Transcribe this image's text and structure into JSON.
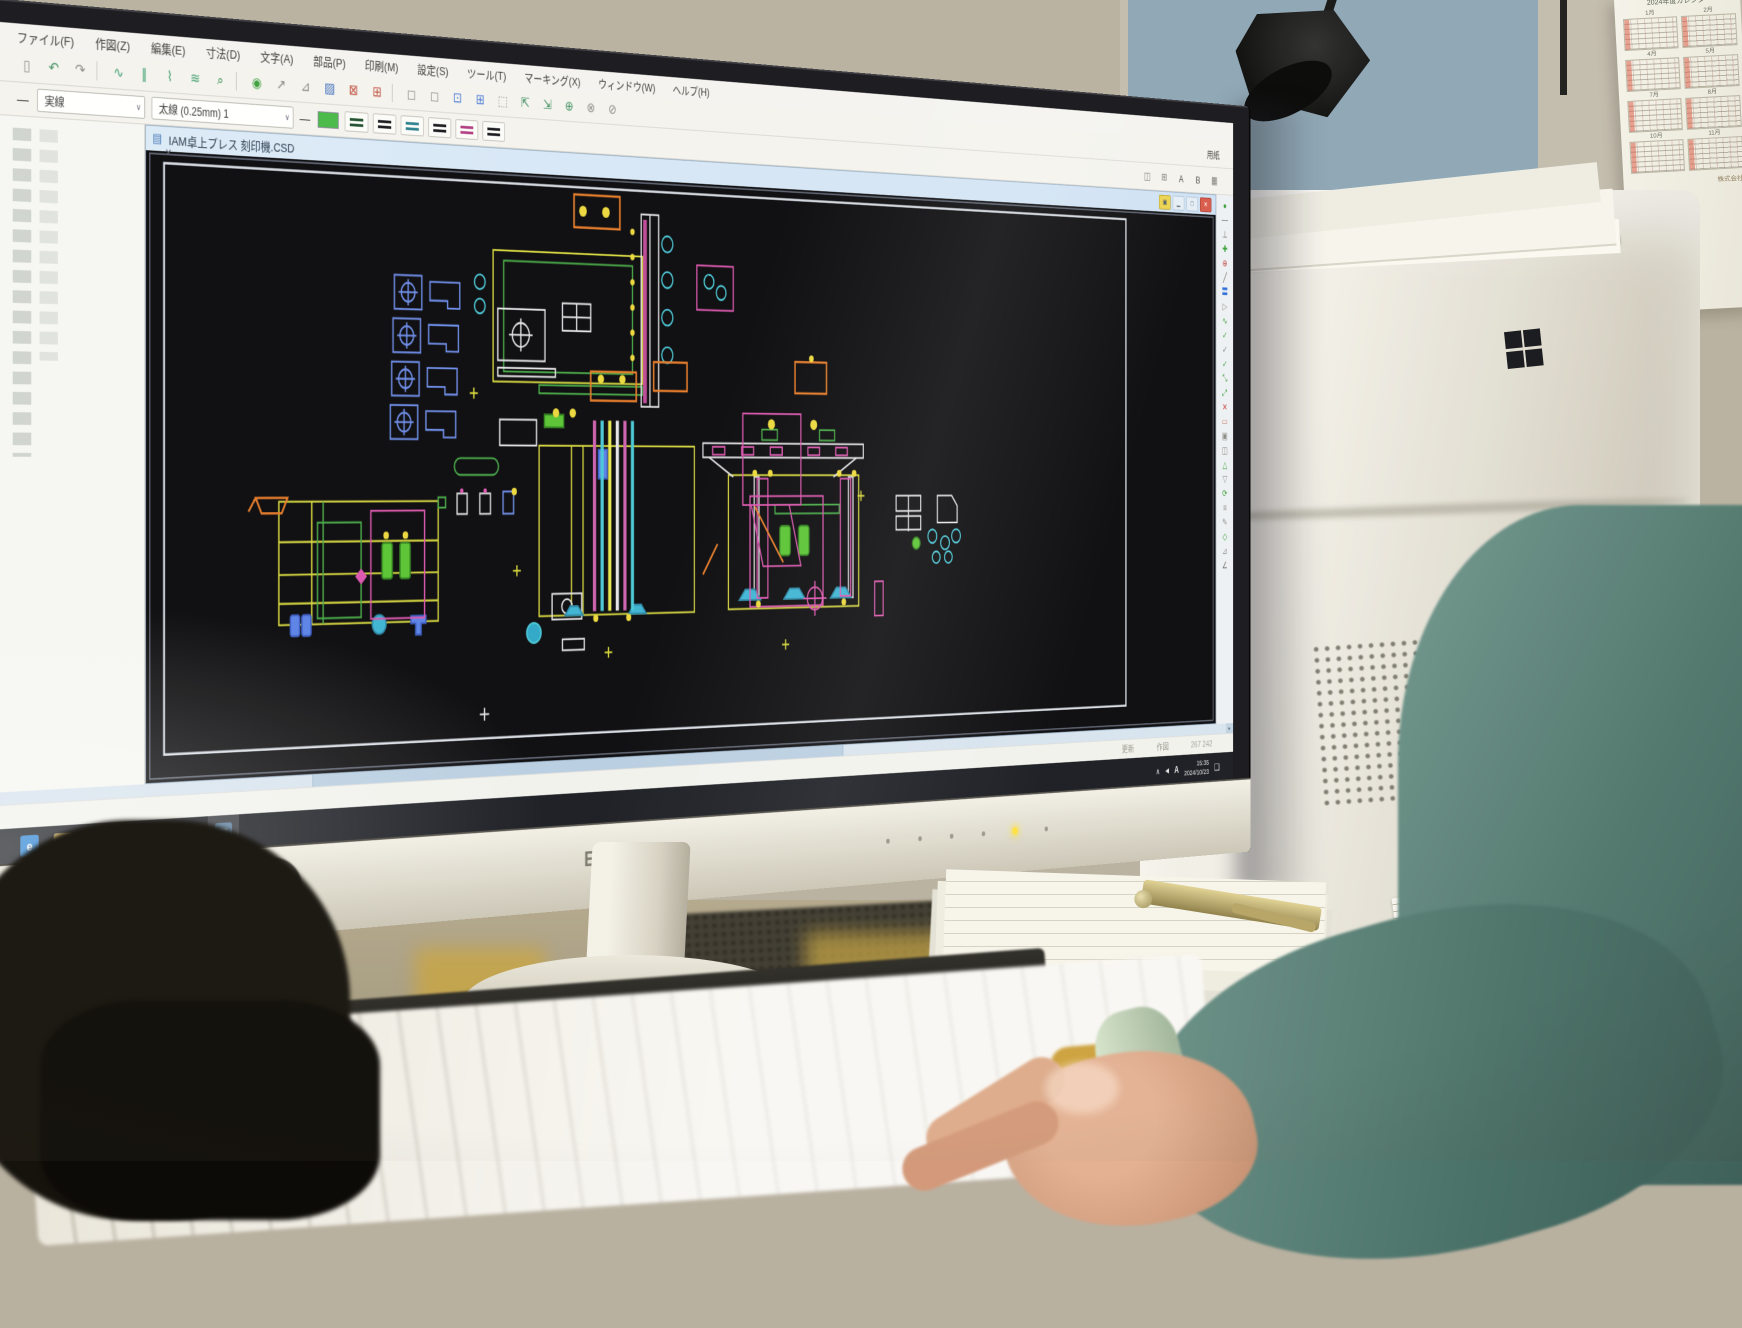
{
  "scene": {
    "monitor": {
      "brand": "EPSON"
    },
    "calendar": {
      "title": "2024年度カレンダー",
      "months": [
        "1月",
        "2月",
        "4月",
        "5月",
        "7月",
        "8月",
        "10月",
        "11月"
      ],
      "footer": "株式会社"
    }
  },
  "app": {
    "menus": [
      "ファイル(F)",
      "作図(Z)",
      "編集(E)",
      "寸法(D)",
      "文字(A)",
      "部品(P)",
      "印刷(M)",
      "設定(S)",
      "ツール(T)",
      "マーキング(X)",
      "ウィンドウ(W)",
      "ヘルプ(H)"
    ],
    "toolbar1": [
      {
        "g": "▯",
        "c": "#8a8a84"
      },
      {
        "g": "↶",
        "c": "#3f8f5f"
      },
      {
        "g": "↷",
        "c": "#8a8a84"
      },
      {
        "g": "",
        "cls": "sep"
      },
      {
        "g": "∿",
        "c": "#3f9f6f"
      },
      {
        "g": "∥",
        "c": "#3f9f6f"
      },
      {
        "g": "⌇",
        "c": "#3f9f6f"
      },
      {
        "g": "≋",
        "c": "#3f9f6f"
      },
      {
        "g": "⌕",
        "c": "#2f8f4f"
      },
      {
        "g": "",
        "cls": "sep"
      },
      {
        "g": "◉",
        "c": "#3a9e3a"
      },
      {
        "g": "↗",
        "c": "#8a8a84"
      },
      {
        "g": "⊿",
        "c": "#8a8a84"
      },
      {
        "g": "▨",
        "c": "#3f6fbf"
      },
      {
        "g": "⊠",
        "c": "#bf4f3f"
      },
      {
        "g": "⊞",
        "c": "#bf4f3f"
      },
      {
        "g": "",
        "cls": "sep"
      },
      {
        "g": "◻",
        "c": "#8a8a84"
      },
      {
        "g": "◻",
        "c": "#8a8a84"
      },
      {
        "g": "⊡",
        "c": "#4a7ad8"
      },
      {
        "g": "⊞",
        "c": "#4a7ad8"
      },
      {
        "g": "⬚",
        "c": "#8a8a84"
      },
      {
        "g": "⇱",
        "c": "#3f8f5f"
      },
      {
        "g": "⇲",
        "c": "#3f8f5f"
      },
      {
        "g": "⊕",
        "c": "#3f8f5f"
      },
      {
        "g": "⊗",
        "c": "#8a8a84"
      },
      {
        "g": "⊘",
        "c": "#8a8a84"
      },
      {
        "g": "",
        "cls": "flex"
      },
      {
        "g": "用紙",
        "cls": "lbl"
      }
    ],
    "toolbar2": {
      "sample": "—",
      "linetype": "実線",
      "linewidth": "太線 (0.25mm) 1",
      "caret": "∨",
      "swatch": "#48b848",
      "styles": [
        "#1d4f2d",
        "#17171c",
        "#2a7f8f",
        "#17171c",
        "#b03a7f",
        "#17171c"
      ],
      "right_icons": [
        {
          "g": "◫",
          "c": "#7a7a74"
        },
        {
          "g": "⊞",
          "c": "#7a7a74"
        },
        {
          "g": "A",
          "c": "#4a4a44"
        },
        {
          "g": "B",
          "c": "#4a4a44"
        },
        {
          "g": "▦",
          "c": "#7a7a74"
        }
      ],
      "panel_close": "×"
    },
    "doc": {
      "title": "IAM卓上プレス 刻印機.CSD",
      "tab_icon": "▤",
      "controls": {
        "layer": "▣",
        "min": "▁",
        "max": "□",
        "close": "✕"
      }
    },
    "right_toolbar": [
      {
        "g": "●",
        "c": "#3a9e3a"
      },
      {
        "g": "—",
        "c": "#66665f"
      },
      {
        "g": "⊥",
        "c": "#66665f"
      },
      {
        "g": "✚",
        "c": "#2f9f2f"
      },
      {
        "g": "⊕",
        "c": "#c04848"
      },
      {
        "g": "╱",
        "c": "#66665f"
      },
      {
        "g": "〓",
        "c": "#2a6ed8"
      },
      {
        "g": "▷",
        "c": "#8a8a84"
      },
      {
        "g": "∿",
        "c": "#3a9e3a"
      },
      {
        "g": "✓",
        "c": "#3a9e3a"
      },
      {
        "g": "✓",
        "c": "#7a7a74"
      },
      {
        "g": "✓",
        "c": "#3a9e3a"
      },
      {
        "g": "⤡",
        "c": "#3a9e3a"
      },
      {
        "g": "⤢",
        "c": "#3a9e3a"
      },
      {
        "g": "✕",
        "c": "#c84040"
      },
      {
        "g": "▭",
        "c": "#c87a6a"
      },
      {
        "g": "▣",
        "c": "#8a8a84"
      },
      {
        "g": "◫",
        "c": "#8a8a84"
      },
      {
        "g": "△",
        "c": "#3a9e3a"
      },
      {
        "g": "▽",
        "c": "#8a8a84"
      },
      {
        "g": "⟳",
        "c": "#3a9e3a"
      },
      {
        "g": "≡",
        "c": "#8a8a84"
      },
      {
        "g": "✎",
        "c": "#8a8a84"
      },
      {
        "g": "◇",
        "c": "#3a9e3a"
      },
      {
        "g": "⊿",
        "c": "#8a8a84"
      },
      {
        "g": "∠",
        "c": "#66665f"
      }
    ],
    "status": {
      "left": [
        "更新",
        "作図"
      ],
      "coords": "267   242"
    },
    "taskbar": {
      "apps": [
        {
          "name": "internet-explorer",
          "glyph": "e",
          "fg": "#ffffff",
          "bg": "#2f86d6",
          "state": "running"
        },
        {
          "name": "file-explorer",
          "glyph": "▭",
          "fg": "#8a6a1f",
          "bg": "#f2cc66",
          "state": "running"
        },
        {
          "name": "excel",
          "glyph": "X",
          "fg": "#ffffff",
          "bg": "#1e7145",
          "state": ""
        },
        {
          "name": "cad-app",
          "glyph": "●",
          "fg": "#e88aa8",
          "bg": "#f6eef0",
          "state": ""
        },
        {
          "name": "calculator",
          "glyph": "▦",
          "fg": "#444444",
          "bg": "#ececec",
          "state": ""
        },
        {
          "name": "figure-app",
          "glyph": "♟",
          "fg": "#e8d8a8",
          "bg": "#3c3731",
          "state": "running"
        },
        {
          "name": "cad-document",
          "glyph": "▤",
          "fg": "#e8f0f8",
          "bg": "#5d7f9f",
          "state": "running active"
        }
      ],
      "tray": {
        "chevron": "∧",
        "volume": "◀",
        "ime": "A",
        "time": "15:35",
        "date": "2024/10/23",
        "action": "❏"
      }
    }
  }
}
